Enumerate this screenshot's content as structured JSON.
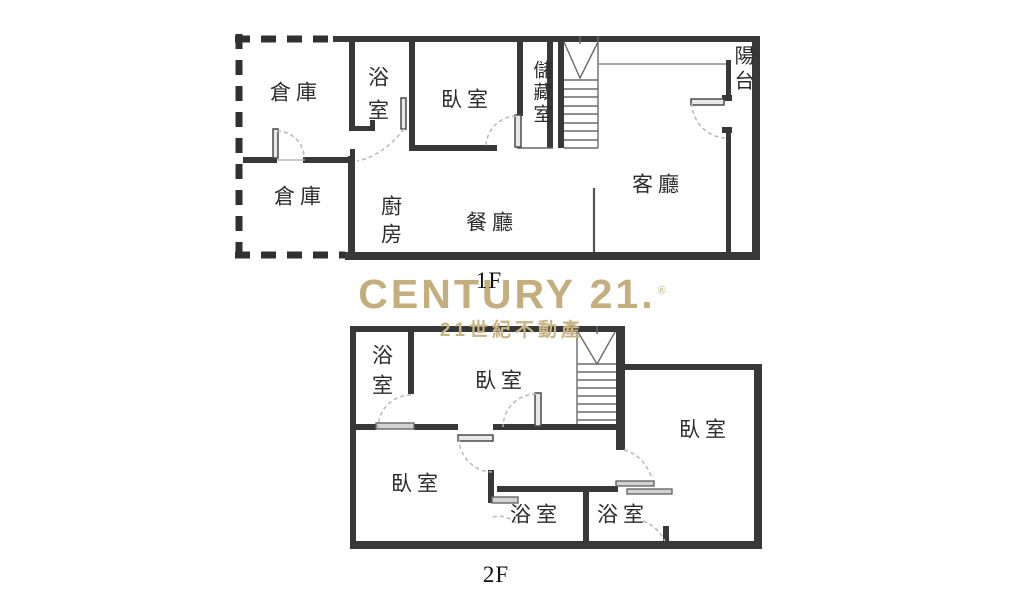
{
  "brand": {
    "logo_text": "CENTURY 21.",
    "registered_mark": "®",
    "tagline": "21世紀不動產",
    "gold_color": "#C4AE7D"
  },
  "floor1": {
    "label": "1F",
    "rooms": {
      "storage_upper": "倉庫",
      "storage_lower": "倉庫",
      "bathroom": "浴室",
      "bedroom": "臥室",
      "storage_room": "儲藏室",
      "balcony": "陽台",
      "living_room": "客廳",
      "dining_room": "餐廳",
      "kitchen": "廚房"
    }
  },
  "floor2": {
    "label": "2F",
    "rooms": {
      "bathroom_top": "浴室",
      "bedroom_top": "臥室",
      "bedroom_right": "臥室",
      "bedroom_left": "臥室",
      "bathroom_middle": "浴室",
      "bathroom_right": "浴室"
    }
  }
}
